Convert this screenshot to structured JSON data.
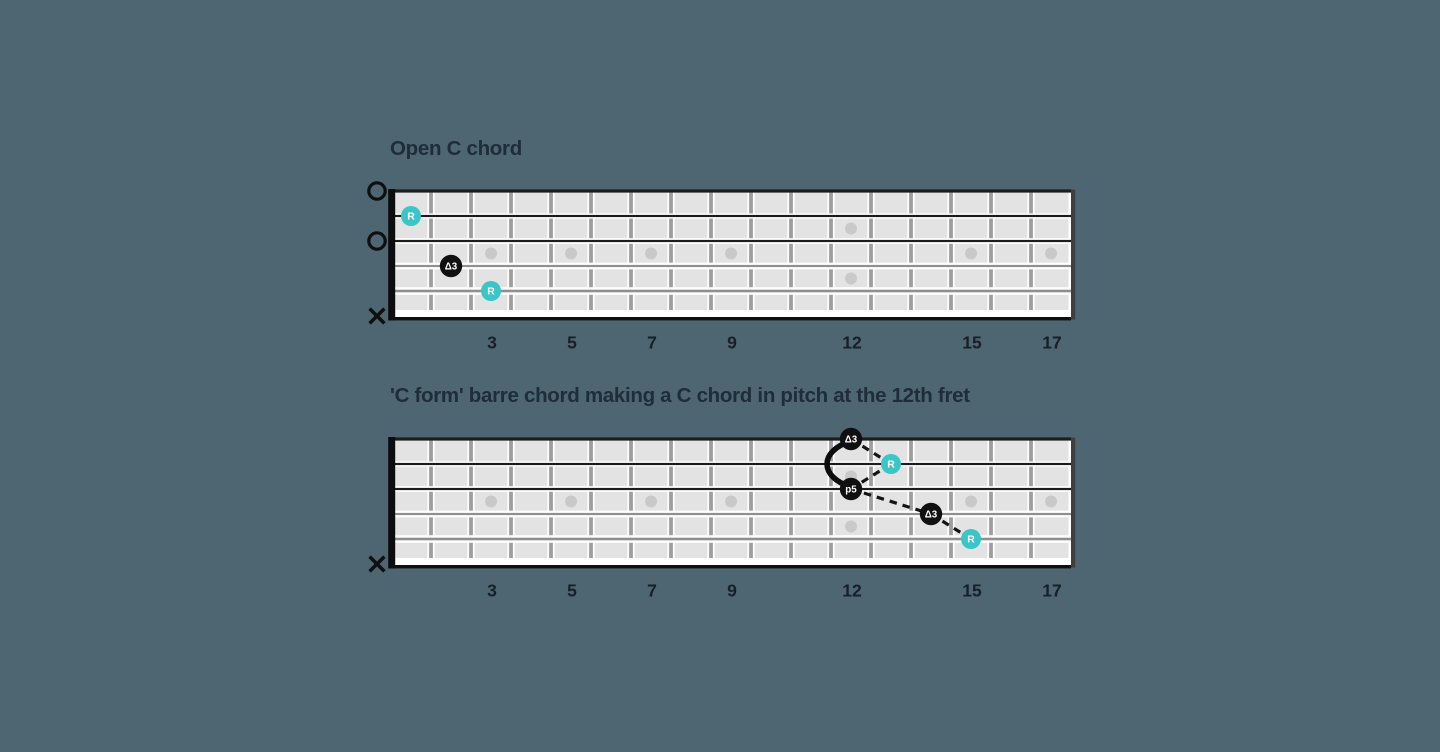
{
  "canvas": {
    "background": "#4d6671"
  },
  "colors": {
    "board_fill": "#e3e3e3",
    "fret_wire": "#9e9e9e",
    "string_halo": "#ffffff",
    "string_plain": "#1c1c1c",
    "string_wound": "#8f8f8f",
    "board_edge": "#0f0f0f",
    "right_edge": "#3f3f3f",
    "nut": "#0d0d0d",
    "inlay_dot": "#c9c9c9",
    "marker_root_fill": "#3ac5c7",
    "marker_interval_fill": "#101010",
    "marker_label": "#ffffff",
    "indicator": "#0f0f0f",
    "connector": "#141414",
    "title_text": "#1f2c3a",
    "fret_label_text": "#181f28"
  },
  "diagrams": [
    {
      "id": "open-c",
      "title": "Open C chord",
      "fret_count": 17,
      "string_count": 6,
      "fret_labels": [
        "3",
        "5",
        "7",
        "9",
        "12",
        "15",
        "17"
      ],
      "inlay_single_frets": [
        3,
        5,
        7,
        9,
        15,
        17
      ],
      "inlay_double_frets": [
        12
      ],
      "left_indicators": [
        {
          "string": 1,
          "type": "open"
        },
        {
          "string": 3,
          "type": "open"
        },
        {
          "string": 6,
          "type": "muted"
        }
      ],
      "markers": [
        {
          "fret": 1,
          "string": 2,
          "label": "R",
          "role": "root"
        },
        {
          "fret": 2,
          "string": 4,
          "label": "Δ3",
          "role": "interval"
        },
        {
          "fret": 3,
          "string": 5,
          "label": "R",
          "role": "root"
        }
      ],
      "connections": [],
      "barres": []
    },
    {
      "id": "c-form-barre",
      "title": "'C form' barre chord making a C chord in pitch at the 12th fret",
      "fret_count": 17,
      "string_count": 6,
      "fret_labels": [
        "3",
        "5",
        "7",
        "9",
        "12",
        "15",
        "17"
      ],
      "inlay_single_frets": [
        3,
        5,
        7,
        9,
        15,
        17
      ],
      "inlay_double_frets": [
        12
      ],
      "left_indicators": [
        {
          "string": 6,
          "type": "muted"
        }
      ],
      "markers": [
        {
          "fret": 12,
          "string": 1,
          "label": "Δ3",
          "role": "interval"
        },
        {
          "fret": 13,
          "string": 2,
          "label": "R",
          "role": "root"
        },
        {
          "fret": 12,
          "string": 3,
          "label": "p5",
          "role": "interval"
        },
        {
          "fret": 14,
          "string": 4,
          "label": "Δ3",
          "role": "interval"
        },
        {
          "fret": 15,
          "string": 5,
          "label": "R",
          "role": "root"
        }
      ],
      "connections": [
        [
          0,
          1
        ],
        [
          1,
          2
        ],
        [
          2,
          3
        ],
        [
          3,
          4
        ]
      ],
      "barres": [
        {
          "from": 0,
          "to": 2
        }
      ]
    }
  ]
}
